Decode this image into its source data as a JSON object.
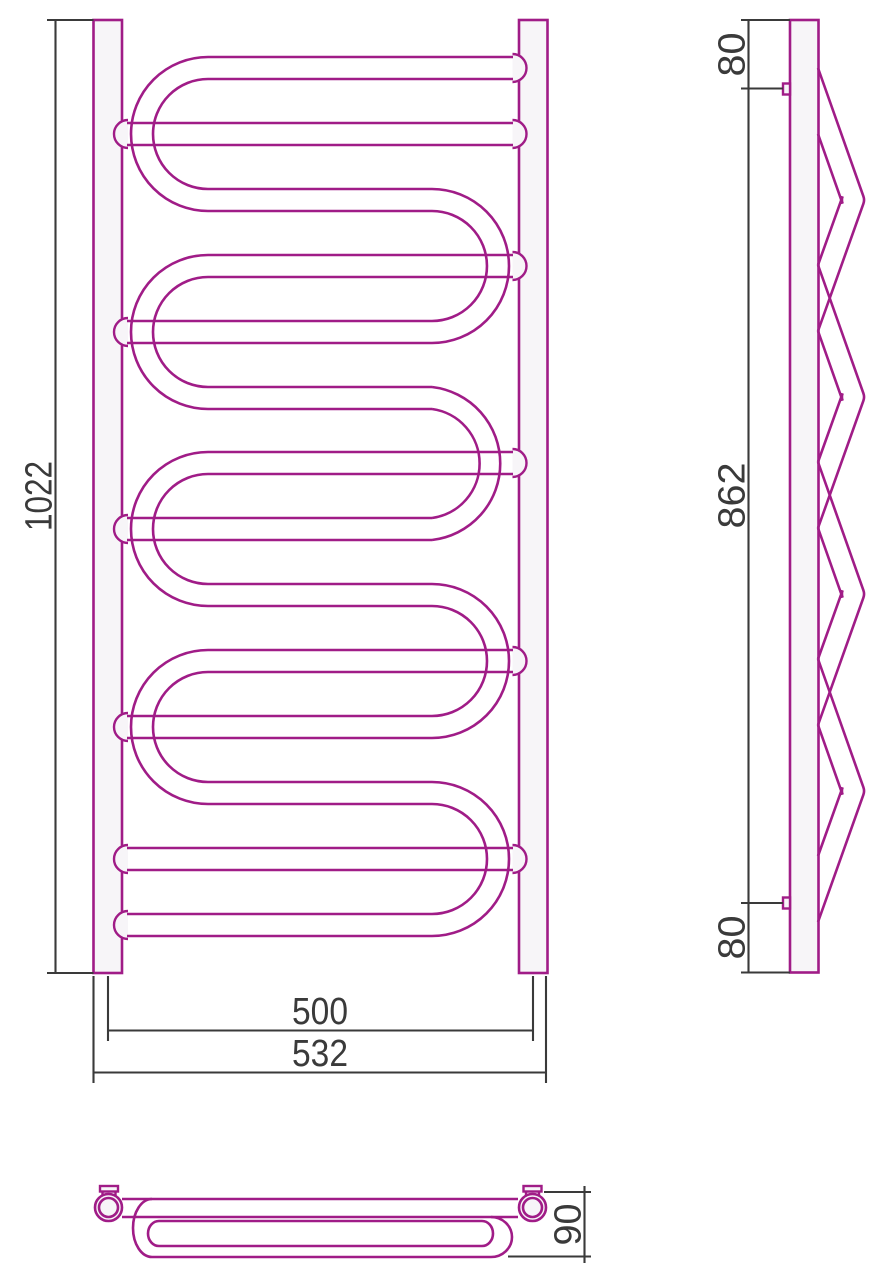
{
  "drawing": {
    "type": "technical-drawing-towel-radiator",
    "views": {
      "front": {
        "height_label": "1022",
        "axis_width_label": "500",
        "overall_width_label": "532"
      },
      "side": {
        "top_offset_label": "80",
        "bracket_span_label": "862",
        "bottom_offset_label": "80"
      },
      "top": {
        "depth_label": "90"
      }
    },
    "colors": {
      "line": "#A01C87",
      "dimension": "#3A3A3A",
      "fill": "#F7F5F8",
      "background": "#FFFFFF"
    }
  }
}
